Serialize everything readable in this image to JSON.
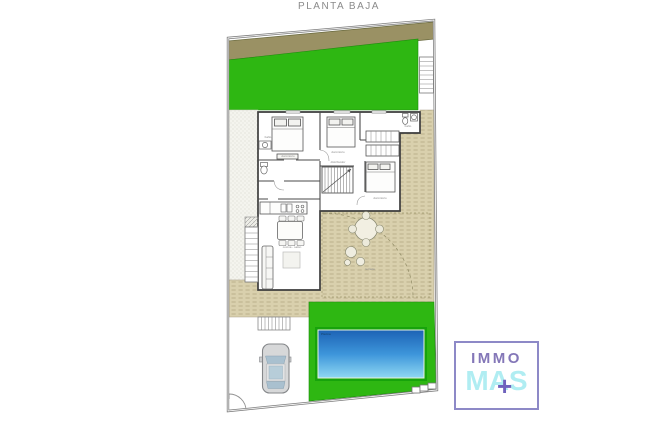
{
  "title": "PLANTA BAJA",
  "plan": {
    "pool_label": "Piscina",
    "rooms": [
      {
        "label": "dormitorio"
      },
      {
        "label": "dormitorio"
      },
      {
        "label": "baño"
      },
      {
        "label": "distribuidor"
      },
      {
        "label": "dormitorio"
      },
      {
        "label": "cocina - salón"
      },
      {
        "label": "terraza"
      },
      {
        "label": "baño"
      }
    ]
  },
  "logo": {
    "top": "IMMO",
    "bottom": "MAS",
    "plus": "+"
  },
  "colors": {
    "lawn_green": "#2eb712",
    "pool_frame_green": "#17a30b",
    "band_olive": "#9a9164",
    "deck_tan": "#d9d0ad",
    "pool_water_top": "#1d63b5",
    "pool_water_bottom": "#8fd8f3",
    "wall": "#3d3d3d",
    "boundary_grey": "#7d7d7d",
    "logo_purple": "#8477b8",
    "logo_cyan": "#b0edf2",
    "logo_plus_purple": "#6f62bd",
    "title_grey": "#8b8b8b"
  }
}
